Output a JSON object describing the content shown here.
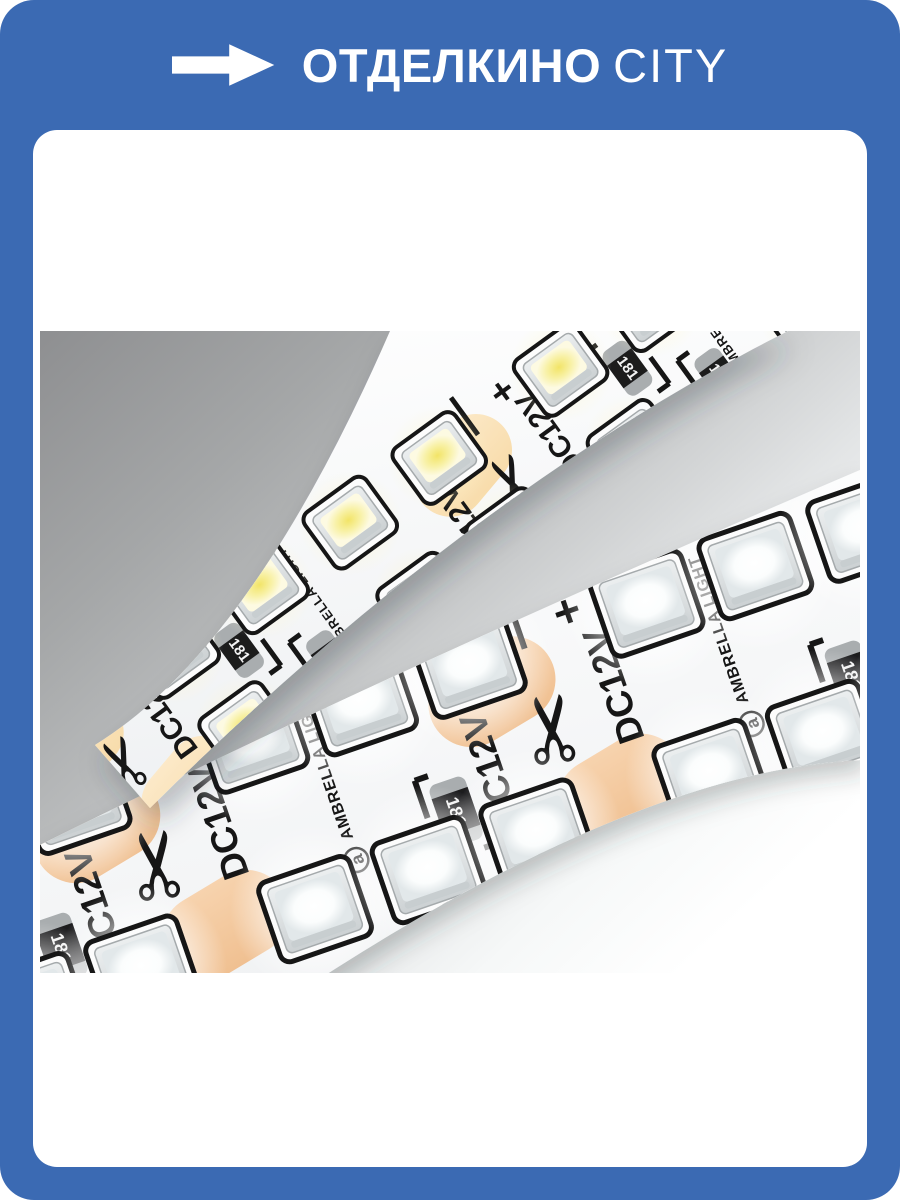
{
  "header": {
    "brand_primary": "ОТДЕЛКИНО",
    "brand_secondary": "CITY"
  },
  "colors": {
    "frame_blue": "#3b6ab3",
    "panel_white": "#ffffff",
    "silkscreen_black": "#161616",
    "strip_body_light": "#ffffff",
    "strip_body_shade": "#eef0f2",
    "warm_led_core": "#f2e467",
    "warm_led_mid": "#f8f1a6",
    "warm_led_edge": "#fdfae2",
    "cool_led_core": "#ffffff",
    "cool_led_edge": "#e2e8ea",
    "package_light": "#eceff0",
    "package_dark": "#ccd1d3",
    "pad_warm_light": "#fce9c8",
    "pad_warm_dark": "#f8dcab",
    "pad_cool_light": "#f7d3ae",
    "pad_cool_dark": "#f0c091",
    "resistor_body": "#1b1b1d",
    "resistor_cap": "#a9adaf",
    "resistor_text": "#f2f2f2",
    "bg_dark": "#8e8f91",
    "bg_mid": "#c3c5c6",
    "bg_light": "#ffffff"
  },
  "photo": {
    "strips": [
      {
        "id": "warm-white-led-strip",
        "led_type": "warm white",
        "voltage_marking": "DC12V",
        "resistor_marking": "181",
        "brand_marking": "AMBRELLA LIGHT",
        "brand_logo_letter": "a",
        "polarity_plus": "+",
        "scissors_symbol": "✂"
      },
      {
        "id": "cool-white-led-strip",
        "led_type": "cool white",
        "voltage_marking": "DC12V",
        "resistor_marking": "181",
        "brand_marking": "AMBRELLA LIGHT",
        "brand_logo_letter": "a",
        "polarity_plus": "+",
        "scissors_symbol": "✂"
      }
    ]
  }
}
